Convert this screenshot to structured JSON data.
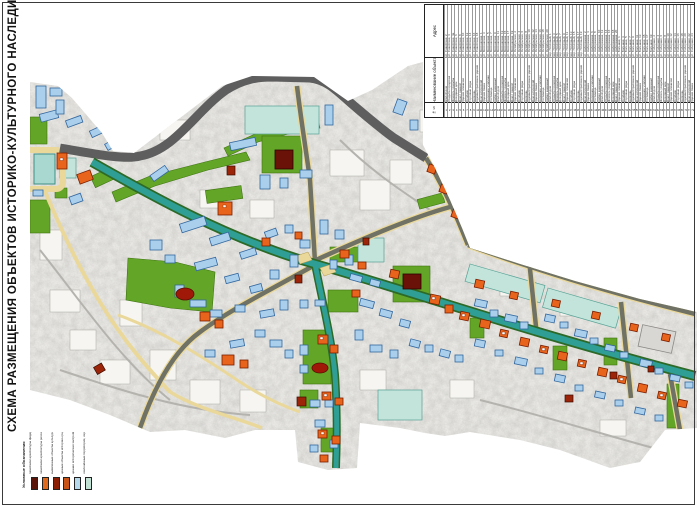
{
  "page": {
    "title": "СХЕМА РАЗМЕЩЕНИЯ ОБЪЕКТОВ ИСТОРИКО-КУЛЬТУРНОГО НАСЛЕДИЯ."
  },
  "palette": {
    "paper": "#ffffff",
    "scan_base": "#e9e8e4",
    "road_dark": "#5e5e5e",
    "road_olive": "#6f7264",
    "road_yellow": "#ead89a",
    "avenue_teal": "#2f9e94",
    "avenue_edge": "#2d6a28",
    "green_area": "#63a527",
    "teal_zone": "#c2e4da",
    "pond": "#a8d8cf",
    "bld_blue": "#a9cfec",
    "bld_blue_edge": "#33679e",
    "bld_orange": "#e8641c",
    "bld_orange_edge": "#7a1e00",
    "bld_darkred": "#9c2408",
    "bld_maroon": "#6b1208"
  },
  "table": {
    "headers": {
      "address": "Адрес",
      "name": "Наименование объекта",
      "num": "№ п/п"
    },
    "entries": [
      [
        1,
        "Жилой дом",
        "ул. Советская, 2"
      ],
      [
        2,
        "Усадьба городская",
        "ул. Советская, 4"
      ],
      [
        3,
        "Флигель усадьбы",
        "ул. Советская, 4а"
      ],
      [
        4,
        "Доходный дом",
        "ул. Советская, 6"
      ],
      [
        5,
        "Дом с лавкой",
        "ул. Советская, 8"
      ],
      [
        6,
        "Здание гимназии",
        "ул. Советская, 10"
      ],
      [
        7,
        "Особняк",
        "ул. Советская, 12"
      ],
      [
        8,
        "Торговые ряды",
        "ул. Советская, 14"
      ],
      [
        9,
        "Церковь",
        "ул. Советская, 16"
      ],
      [
        10,
        "Административное здание",
        "ул. Советская, 18"
      ],
      [
        11,
        "Дом купеческий",
        "ул. Московская, 1"
      ],
      [
        12,
        "Здание банка",
        "ул. Московская, 3"
      ],
      [
        13,
        "Народное училище",
        "ул. Московская, 5"
      ],
      [
        14,
        "Гостиница",
        "ул. Московская, 7"
      ],
      [
        15,
        "Амбар каменный",
        "ул. Московская, 9"
      ],
      [
        16,
        "Жилой дом",
        "ул. Московская, 11"
      ],
      [
        17,
        "Усадьба городская",
        "ул. Московская, 13"
      ],
      [
        18,
        "Флигель усадьбы",
        "ул. Московская, 15"
      ],
      [
        19,
        "Доходный дом",
        "ул. Московская, 17"
      ],
      [
        20,
        "Дом с лавкой",
        "ул. Московская, 19"
      ],
      [
        21,
        "Здание гимназии",
        "ул. Октябрьская, 2"
      ],
      [
        22,
        "Особняк",
        "ул. Октябрьская, 4"
      ],
      [
        23,
        "Торговые ряды",
        "ул. Октябрьская, 6"
      ],
      [
        24,
        "Церковь",
        "ул. Октябрьская, 8"
      ],
      [
        25,
        "Административное здание",
        "ул. Октябрьская, 10"
      ],
      [
        26,
        "Дом купеческий",
        "ул. Октябрьская, 12"
      ],
      [
        27,
        "Здание банка",
        "ул. Октябрьская, 14"
      ],
      [
        28,
        "Народное училище",
        "ул. Октябрьская, 16"
      ],
      [
        29,
        "Гостиница",
        "ул. Октябрьская, 18"
      ],
      [
        30,
        "Амбар каменный",
        "ул. Октябрьская, 20"
      ],
      [
        31,
        "Жилой дом",
        "пер. Почтовый, 1"
      ],
      [
        32,
        "Усадьба городская",
        "пер. Почтовый, 3"
      ],
      [
        33,
        "Флигель усадьбы",
        "пер. Почтовый, 5"
      ],
      [
        34,
        "Доходный дом",
        "пер. Почтовый, 7"
      ],
      [
        35,
        "Дом с лавкой",
        "пер. Почтовый, 9"
      ],
      [
        36,
        "Здание гимназии",
        "пер. Почтовый, 11"
      ],
      [
        37,
        "Особняк",
        "пер. Почтовый, 13"
      ],
      [
        38,
        "Торговые ряды",
        "пер. Почтовый, 15"
      ],
      [
        39,
        "Церковь",
        "пер. Почтовый, 17"
      ],
      [
        40,
        "Административное здание",
        "пер. Почтовый, 19"
      ],
      [
        41,
        "Дом купеческий",
        "ул. Набережная, 2"
      ],
      [
        42,
        "Здание банка",
        "ул. Набережная, 4"
      ],
      [
        43,
        "Народное училище",
        "ул. Набережная, 6"
      ],
      [
        44,
        "Гостиница",
        "ул. Набережная, 8"
      ],
      [
        45,
        "Амбар каменный",
        "ул. Набережная, 10"
      ],
      [
        46,
        "Жилой дом",
        "ул. Набережная, 12"
      ],
      [
        47,
        "Усадьба городская",
        "ул. Набережная, 14"
      ],
      [
        48,
        "Флигель усадьбы",
        "ул. Набережная, 16"
      ],
      [
        49,
        "Доходный дом",
        "ул. Набережная, 18"
      ],
      [
        50,
        "Дом с лавкой",
        "ул. Набережная, 20"
      ],
      [
        51,
        "Здание гимназии",
        "ул. Большая, 1"
      ],
      [
        52,
        "Особняк",
        "ул. Большая, 3"
      ],
      [
        53,
        "Торговые ряды",
        "ул. Большая, 5"
      ],
      [
        54,
        "Церковь",
        "ул. Большая, 7"
      ],
      [
        55,
        "Административное здание",
        "ул. Большая, 9"
      ],
      [
        56,
        "Дом купеческий",
        "ул. Большая, 11"
      ],
      [
        57,
        "Здание банка",
        "ул. Большая, 13"
      ],
      [
        58,
        "Народное училище",
        "ул. Большая, 15"
      ],
      [
        59,
        "Гостиница",
        "ул. Большая, 17"
      ],
      [
        60,
        "Амбар каменный",
        "ул. Большая, 19"
      ],
      [
        61,
        "Жилой дом",
        "ул. Соборная, 2"
      ],
      [
        62,
        "Усадьба городская",
        "ул. Соборная, 4"
      ],
      [
        63,
        "Флигель усадьбы",
        "ул. Соборная, 6"
      ],
      [
        64,
        "Доходный дом",
        "ул. Соборная, 8"
      ],
      [
        65,
        "Дом с лавкой",
        "ул. Соборная, 10"
      ],
      [
        66,
        "Здание гимназии",
        "ул. Соборная, 12"
      ],
      [
        67,
        "Особняк",
        "ул. Соборная, 14"
      ],
      [
        68,
        "Торговые ряды",
        "ул. Соборная, 16"
      ],
      [
        69,
        "Церковь",
        "ул. Соборная, 18"
      ],
      [
        70,
        "Административное здание",
        "ул. Соборная, 20"
      ],
      [
        71,
        "Дом купеческий",
        "ул. Соборная, 22"
      ],
      [
        72,
        "Здание банка",
        "ул. Соборная, 24"
      ]
    ]
  },
  "legend": {
    "title": "Условные обозначения",
    "items": [
      {
        "label": "памятники архитектуры федерального значения",
        "color": "#5a1408"
      },
      {
        "label": "памятники архитектуры регионального значения",
        "color": "#e06a1e"
      },
      {
        "label": "выявленные объекты культурного наследия",
        "color": "#8c1e04"
      },
      {
        "label": "ценные объекты историко-градостроительной среды",
        "color": "#c85314"
      },
      {
        "label": "ценная историческая застройка",
        "color": "#b6d9ec"
      },
      {
        "label": "озеленённые территории, охраняемый ландшафт",
        "color": "#c2e2d6"
      }
    ]
  }
}
